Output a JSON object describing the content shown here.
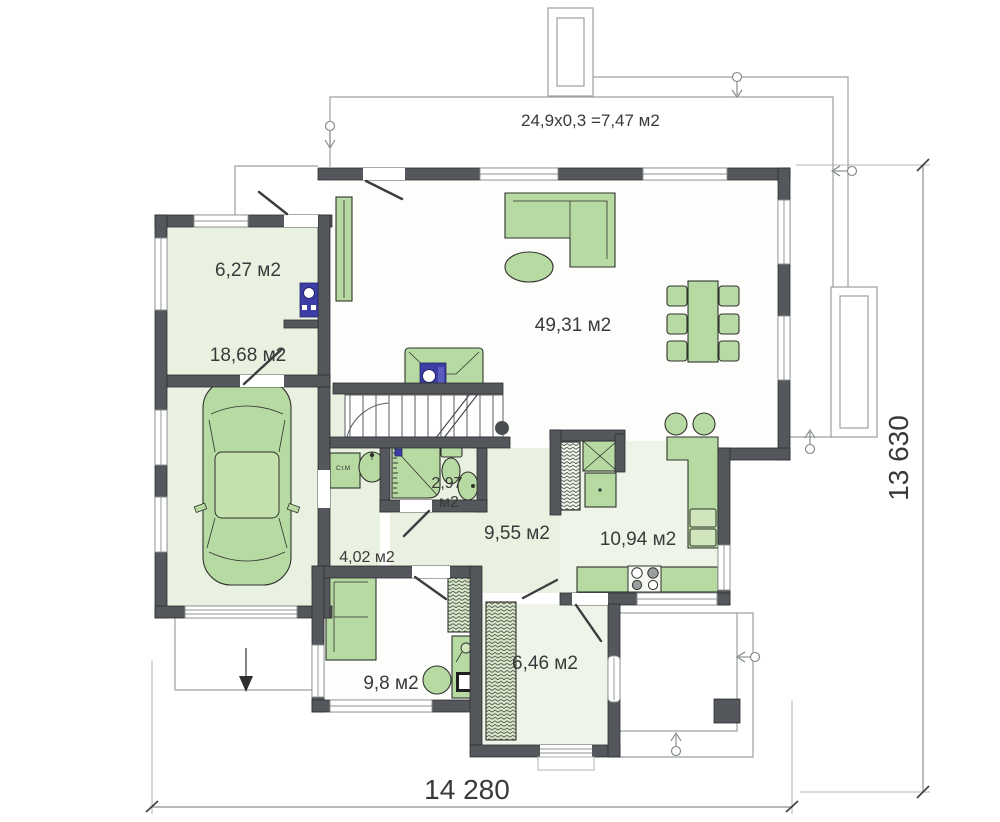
{
  "plan": {
    "roof_note": "24,9х0,3 =7,47 м2",
    "dim_width": "14 280",
    "dim_height": "13 630",
    "rooms": {
      "tambour": "6,27 м2",
      "garage": "18,68 м2",
      "living": "49,31 м2",
      "bath_val": "2,97",
      "bath_unit": "м2",
      "hall": "9,55 м2",
      "laundry": "4,02 м2",
      "kitchen": "10,94 м2",
      "cabinet": "9,8 м2",
      "entry": "6,46 м2"
    },
    "equipment": {
      "washer": "Ст.М"
    },
    "colors": {
      "wall": "#54575b",
      "room_fill": "#e9f2e0",
      "furniture": "#b7daa2",
      "accent_blue": "#3c3ea6",
      "outline": "#9aa0a1"
    }
  }
}
